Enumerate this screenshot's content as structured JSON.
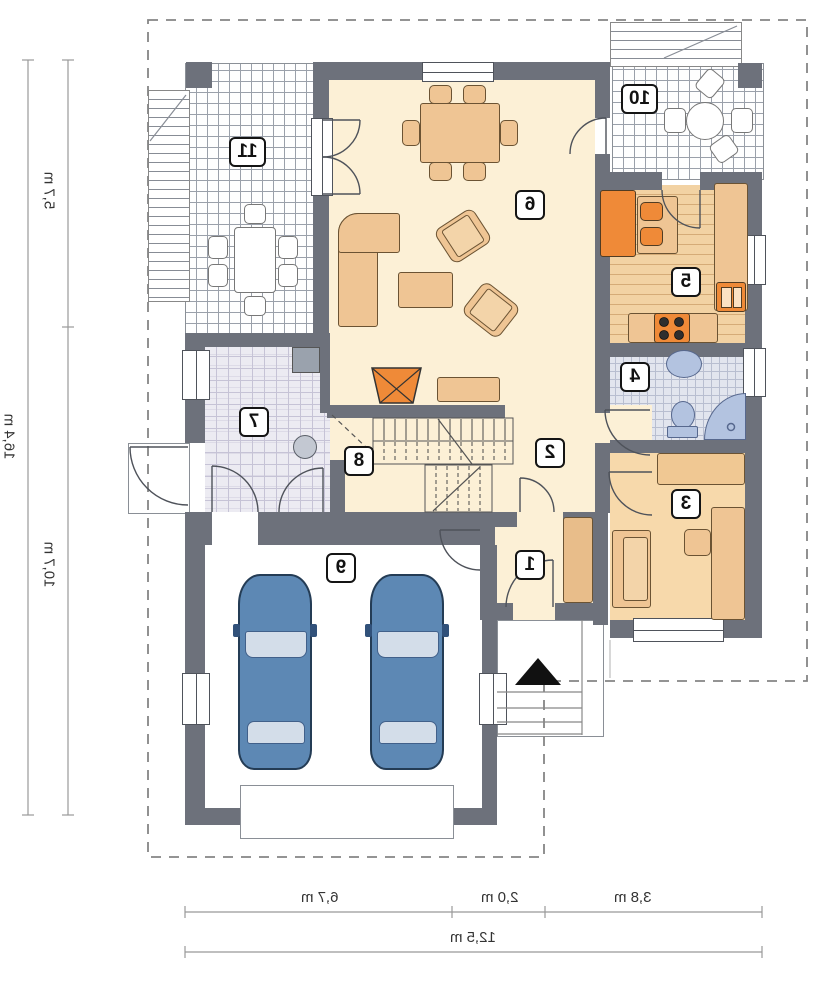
{
  "rooms": [
    {
      "number": "1"
    },
    {
      "number": "2"
    },
    {
      "number": "3"
    },
    {
      "number": "4"
    },
    {
      "number": "5"
    },
    {
      "number": "6"
    },
    {
      "number": "7"
    },
    {
      "number": "8"
    },
    {
      "number": "9"
    },
    {
      "number": "10"
    },
    {
      "number": "11"
    }
  ],
  "dimensions": {
    "left": {
      "outer_total": "16,4 m",
      "top_segment": "5,7 m",
      "bottom_segment": "10,7 m"
    },
    "bottom": {
      "segments": [
        "6,7 m",
        "2,0 m",
        "3,8 m"
      ],
      "total": "12,5 m"
    }
  },
  "colors": {
    "wall": "#6d717b",
    "floor_cream": "#fcf0d6",
    "floor_peach": "#f7d9ab",
    "furniture_tan": "#efc594",
    "accent_orange": "#ef8a38",
    "fixture_blue": "#b3c3e0",
    "car_blue": "#5d88b4"
  }
}
